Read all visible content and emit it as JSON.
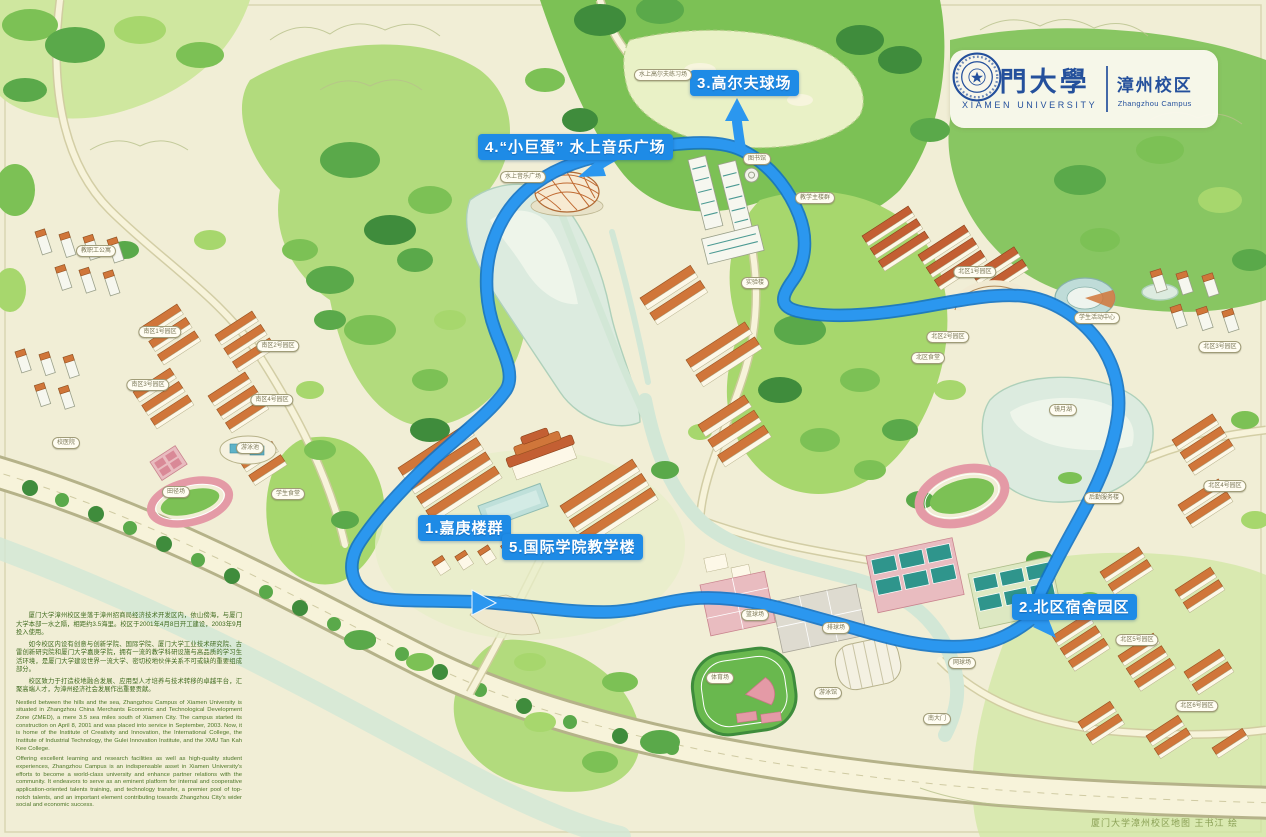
{
  "branding": {
    "university_zh": "厦門大學",
    "university_en": "XIAMEN UNIVERSITY",
    "campus_zh": "漳州校区",
    "campus_en": "Zhangzhou Campus",
    "brand_color": "#24509c"
  },
  "route": {
    "color": "#2b97ef",
    "casing_color": "#1272c4",
    "stops": [
      {
        "label": "1.嘉庚楼群",
        "x": 418,
        "y": 515
      },
      {
        "label": "2.北区宿舍园区",
        "x": 1012,
        "y": 594
      },
      {
        "label": "3.高尔夫球场",
        "x": 690,
        "y": 70
      },
      {
        "label": "4.“小巨蛋” 水上音乐广场",
        "x": 478,
        "y": 134
      },
      {
        "label": "5.国际学院教学楼",
        "x": 502,
        "y": 534
      }
    ]
  },
  "map_labels": [
    {
      "text": "水上高尔夫练习场",
      "x": 663,
      "y": 75
    },
    {
      "text": "水上音乐广场",
      "x": 523,
      "y": 177
    },
    {
      "text": "教职工公寓",
      "x": 96,
      "y": 251
    },
    {
      "text": "南区1号园区",
      "x": 160,
      "y": 332
    },
    {
      "text": "南区2号园区",
      "x": 278,
      "y": 346
    },
    {
      "text": "南区3号园区",
      "x": 148,
      "y": 385
    },
    {
      "text": "南区4号园区",
      "x": 272,
      "y": 400
    },
    {
      "text": "校医院",
      "x": 66,
      "y": 443
    },
    {
      "text": "游泳池",
      "x": 250,
      "y": 448
    },
    {
      "text": "田径场",
      "x": 176,
      "y": 492
    },
    {
      "text": "学生食堂",
      "x": 288,
      "y": 494
    },
    {
      "text": "图书馆",
      "x": 757,
      "y": 159
    },
    {
      "text": "教学主楼群",
      "x": 815,
      "y": 198
    },
    {
      "text": "实验楼",
      "x": 755,
      "y": 283
    },
    {
      "text": "北区1号园区",
      "x": 975,
      "y": 272
    },
    {
      "text": "北区2号园区",
      "x": 948,
      "y": 337
    },
    {
      "text": "北区食堂",
      "x": 928,
      "y": 358
    },
    {
      "text": "学生活动中心",
      "x": 1097,
      "y": 318
    },
    {
      "text": "镜月湖",
      "x": 1063,
      "y": 410
    },
    {
      "text": "北区3号园区",
      "x": 1220,
      "y": 347
    },
    {
      "text": "北区4号园区",
      "x": 1225,
      "y": 486
    },
    {
      "text": "后勤服务楼",
      "x": 1104,
      "y": 498
    },
    {
      "text": "篮球场",
      "x": 755,
      "y": 615
    },
    {
      "text": "排球场",
      "x": 836,
      "y": 628
    },
    {
      "text": "网球场",
      "x": 962,
      "y": 663
    },
    {
      "text": "体育场",
      "x": 720,
      "y": 678
    },
    {
      "text": "游泳馆",
      "x": 828,
      "y": 693
    },
    {
      "text": "南大门",
      "x": 937,
      "y": 719
    },
    {
      "text": "北区5号园区",
      "x": 1137,
      "y": 640
    },
    {
      "text": "北区6号园区",
      "x": 1197,
      "y": 706
    }
  ],
  "description": {
    "paragraphs_zh": [
      "厦门大学漳州校区坐落于漳州招商局经济技术开发区内，依山傍海，与厦门大学本部一水之隔，相距约3.5海里。校区于2001年4月8日开工建设，2003年9月投入使用。",
      "如今校区内设有创意与创新学院、国际学院、厦门大学工业技术研究院、古雷创新研究院和厦门大学嘉庚学院，拥有一流的教学科研设施与高品质的学习生活环境，是厦门大学建设世界一流大学、密切校地伙伴关系不可或缺的重要组成部分。",
      "校区致力于打造校地融合发展、应用型人才培养与技术转移的卓越平台，汇聚高端人才，为漳州经济社会发展作出重要贡献。"
    ],
    "paragraphs_en": [
      "Nestled between the hills and the sea, Zhangzhou Campus of Xiamen University is situated in Zhangzhou China Merchants Economic and Technological Development Zone (ZMED), a mere 3.5 sea miles south of Xiamen City. The campus started its construction on April 8, 2001 and was placed into service in September, 2003. Now, it is home of the Institute of Creativity and Innovation, the International College, the Institute of Industrial Technology, the Gulei Innovation Institute, and the XMU Tan Kah Kee College.",
      "Offering excellent learning and research facilities as well as high-quality student experiences, Zhangzhou Campus is an indispensable asset in Xiamen University's efforts to become a world-class university and enhance partner relations with the community. It endeavors to serve as an eminent platform for internal and cooperative application-oriented talents training, and technology transfer, a premier pool of top-notch talents, and an important element contributing towards Zhangzhou City's wider social and economic success."
    ]
  },
  "credit": "厦门大学漳州校区地图 王书江 绘"
}
